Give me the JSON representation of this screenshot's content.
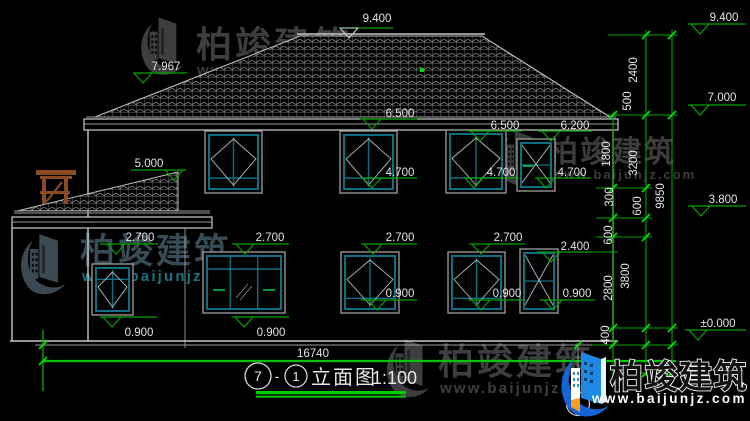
{
  "drawing": {
    "type": "building-elevation-cad-drawing",
    "overall_width": "16740",
    "axis_bubble": "1"
  },
  "title": {
    "axis_start": "7",
    "separator": "-",
    "axis_end": "1",
    "name": "立面图",
    "scale": "1:100"
  },
  "watermark": {
    "brand": "柏竣建筑",
    "url": "www.baijunjz.com"
  },
  "colors": {
    "background": "#000000",
    "drawing_line": "#c9c9c9",
    "window_frame_cyan": "#0f6f82",
    "dimension_green": "#00a400",
    "bright_tick_green": "#00e000",
    "ground_line_green": "#00c300",
    "title_bar_green": "#00cf00",
    "text": "#e4e4e4",
    "watermark_gray": "#3e3e3e",
    "watermark_teal": "#1a7383",
    "logo_blue": "#1e88e5",
    "logo_orange": "#f59f1c",
    "pergola_brown": "#8a4a22"
  },
  "elevations": [
    {
      "v": "9.400",
      "tx": 377,
      "ty": 22,
      "lx1": 342,
      "lx2": 393,
      "ly": 28,
      "tcx": 349,
      "tri": "light"
    },
    {
      "v": "7.967",
      "tx": 166,
      "ty": 70,
      "lx1": 133,
      "lx2": 187,
      "ly": 73,
      "tcx": 143
    },
    {
      "v": "5.000",
      "tx": 149,
      "ty": 167,
      "lx1": 131,
      "lx2": 186,
      "ly": 170,
      "tcx": 174
    },
    {
      "v": "6.500",
      "tx": 400,
      "ty": 117,
      "lx1": 360,
      "lx2": 417,
      "ly": 119,
      "tcx": 372
    },
    {
      "v": "6.500",
      "tx": 505,
      "ty": 129,
      "lx1": 468,
      "lx2": 522,
      "ly": 131,
      "tcx": 480
    },
    {
      "v": "6.200",
      "tx": 575,
      "ty": 129,
      "lx1": 538,
      "lx2": 592,
      "ly": 131,
      "tcx": 551
    },
    {
      "v": "4.700",
      "tx": 400,
      "ty": 176,
      "lx1": 361,
      "lx2": 417,
      "ly": 178,
      "tcx": 372
    },
    {
      "v": "4.700",
      "tx": 501,
      "ty": 176,
      "lx1": 463,
      "lx2": 519,
      "ly": 178,
      "tcx": 474
    },
    {
      "v": "4.700",
      "tx": 572,
      "ty": 176,
      "lx1": 535,
      "lx2": 590,
      "ly": 178,
      "tcx": 546
    },
    {
      "v": "2.700",
      "tx": 140,
      "ty": 241,
      "lx1": 100,
      "lx2": 158,
      "ly": 244,
      "tcx": 116
    },
    {
      "v": "2.700",
      "tx": 270,
      "ty": 241,
      "lx1": 232,
      "lx2": 289,
      "ly": 244,
      "tcx": 245
    },
    {
      "v": "2.700",
      "tx": 400,
      "ty": 241,
      "lx1": 361,
      "lx2": 417,
      "ly": 244,
      "tcx": 373
    },
    {
      "v": "2.700",
      "tx": 508,
      "ty": 241,
      "lx1": 469,
      "lx2": 525,
      "ly": 244,
      "tcx": 481
    },
    {
      "v": "2.400",
      "tx": 575,
      "ty": 250,
      "lx1": 537,
      "lx2": 592,
      "ly": 252,
      "tcx": 551
    },
    {
      "v": "0.900",
      "tx": 139,
      "ty": 336,
      "lx1": 100,
      "lx2": 157,
      "ly": 317,
      "tcx": 112
    },
    {
      "v": "0.900",
      "tx": 271,
      "ty": 336,
      "lx1": 232,
      "lx2": 289,
      "ly": 317,
      "tcx": 244
    },
    {
      "v": "0.900",
      "tx": 400,
      "ty": 297,
      "lx1": 361,
      "lx2": 417,
      "ly": 300,
      "tcx": 377
    },
    {
      "v": "0.900",
      "tx": 507,
      "ty": 297,
      "lx1": 468,
      "lx2": 524,
      "ly": 300,
      "tcx": 481
    },
    {
      "v": "0.900",
      "tx": 577,
      "ty": 297,
      "lx1": 540,
      "lx2": 595,
      "ly": 300,
      "tcx": 553
    },
    {
      "v": "±0.000",
      "tx": 718,
      "ty": 327,
      "lx1": 685,
      "lx2": 746,
      "ly": 330,
      "tcx": 698
    },
    {
      "v": "9.400",
      "tx": 724,
      "ty": 21,
      "lx1": 688,
      "lx2": 746,
      "ly": 24,
      "tcx": 700
    },
    {
      "v": "7.000",
      "tx": 722,
      "ty": 101,
      "lx1": 688,
      "lx2": 746,
      "ly": 105,
      "tcx": 700
    },
    {
      "v": "3.800",
      "tx": 723,
      "ty": 203,
      "lx1": 688,
      "lx2": 746,
      "ly": 206,
      "tcx": 701
    }
  ],
  "vdims": [
    {
      "v": "2400",
      "x": 637,
      "y": 70
    },
    {
      "v": "500",
      "x": 631,
      "y": 101
    },
    {
      "v": "1800",
      "x": 610,
      "y": 154
    },
    {
      "v": "3200",
      "x": 637,
      "y": 163
    },
    {
      "v": "300",
      "x": 613,
      "y": 197
    },
    {
      "v": "600",
      "x": 641,
      "y": 206
    },
    {
      "v": "600",
      "x": 612,
      "y": 235
    },
    {
      "v": "9850",
      "x": 664,
      "y": 196
    },
    {
      "v": "3800",
      "x": 629,
      "y": 276
    },
    {
      "v": "2800",
      "x": 612,
      "y": 288
    },
    {
      "v": "400",
      "x": 609,
      "y": 335
    }
  ]
}
